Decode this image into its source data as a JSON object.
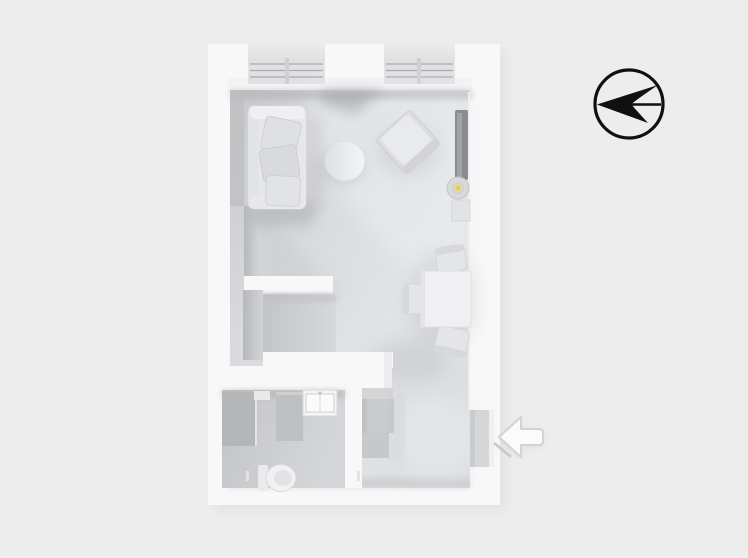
{
  "scene": {
    "type": "floor-plan",
    "view": "3d-top-down",
    "description": "Monochrome 3D rendered floor plan of a studio apartment",
    "background": "#ededed"
  },
  "colors": {
    "background": "#ededed",
    "wall": "#f8f8f9",
    "wall_shade": "#f3f3f4",
    "floor_light": "#e4e6e9",
    "floor_dark": "#c6c8cb",
    "bathroom_floor": "#c7c9cc",
    "shower": "#b4b6b8",
    "furniture_light": "#efeff1",
    "furniture_mid": "#dfe0e3",
    "furniture_dark": "#c9cbcd",
    "tv_panel": "#898b8e",
    "lamp_glow": "#e6cf4b",
    "compass_ink": "#101010",
    "entry_arrow_fill": "#fbfbfa",
    "entry_arrow_stroke": "#d3d3d2"
  },
  "compass": {
    "icon": "north-arrow-icon",
    "pointing": "west"
  },
  "entrance": {
    "icon": "entry-arrow-icon",
    "pointing": "left",
    "wall": "right"
  },
  "rooms": [
    {
      "name": "living-room",
      "items": [
        "sofa",
        "coffee-table",
        "armchair",
        "tv-panel",
        "floor-lamp",
        "media-cabinet",
        "dining-table",
        "dining-chairs"
      ]
    },
    {
      "name": "kitchen-nook",
      "items": [
        "l-shaped-counter"
      ]
    },
    {
      "name": "bathroom",
      "items": [
        "shower",
        "partition",
        "vanity-sink",
        "toilet"
      ]
    },
    {
      "name": "entry-hall",
      "items": [
        "wardrobe",
        "cabinets",
        "entry-door"
      ]
    }
  ],
  "windows": [
    {
      "wall": "top",
      "count": 2,
      "style": "balcony-railing"
    }
  ]
}
